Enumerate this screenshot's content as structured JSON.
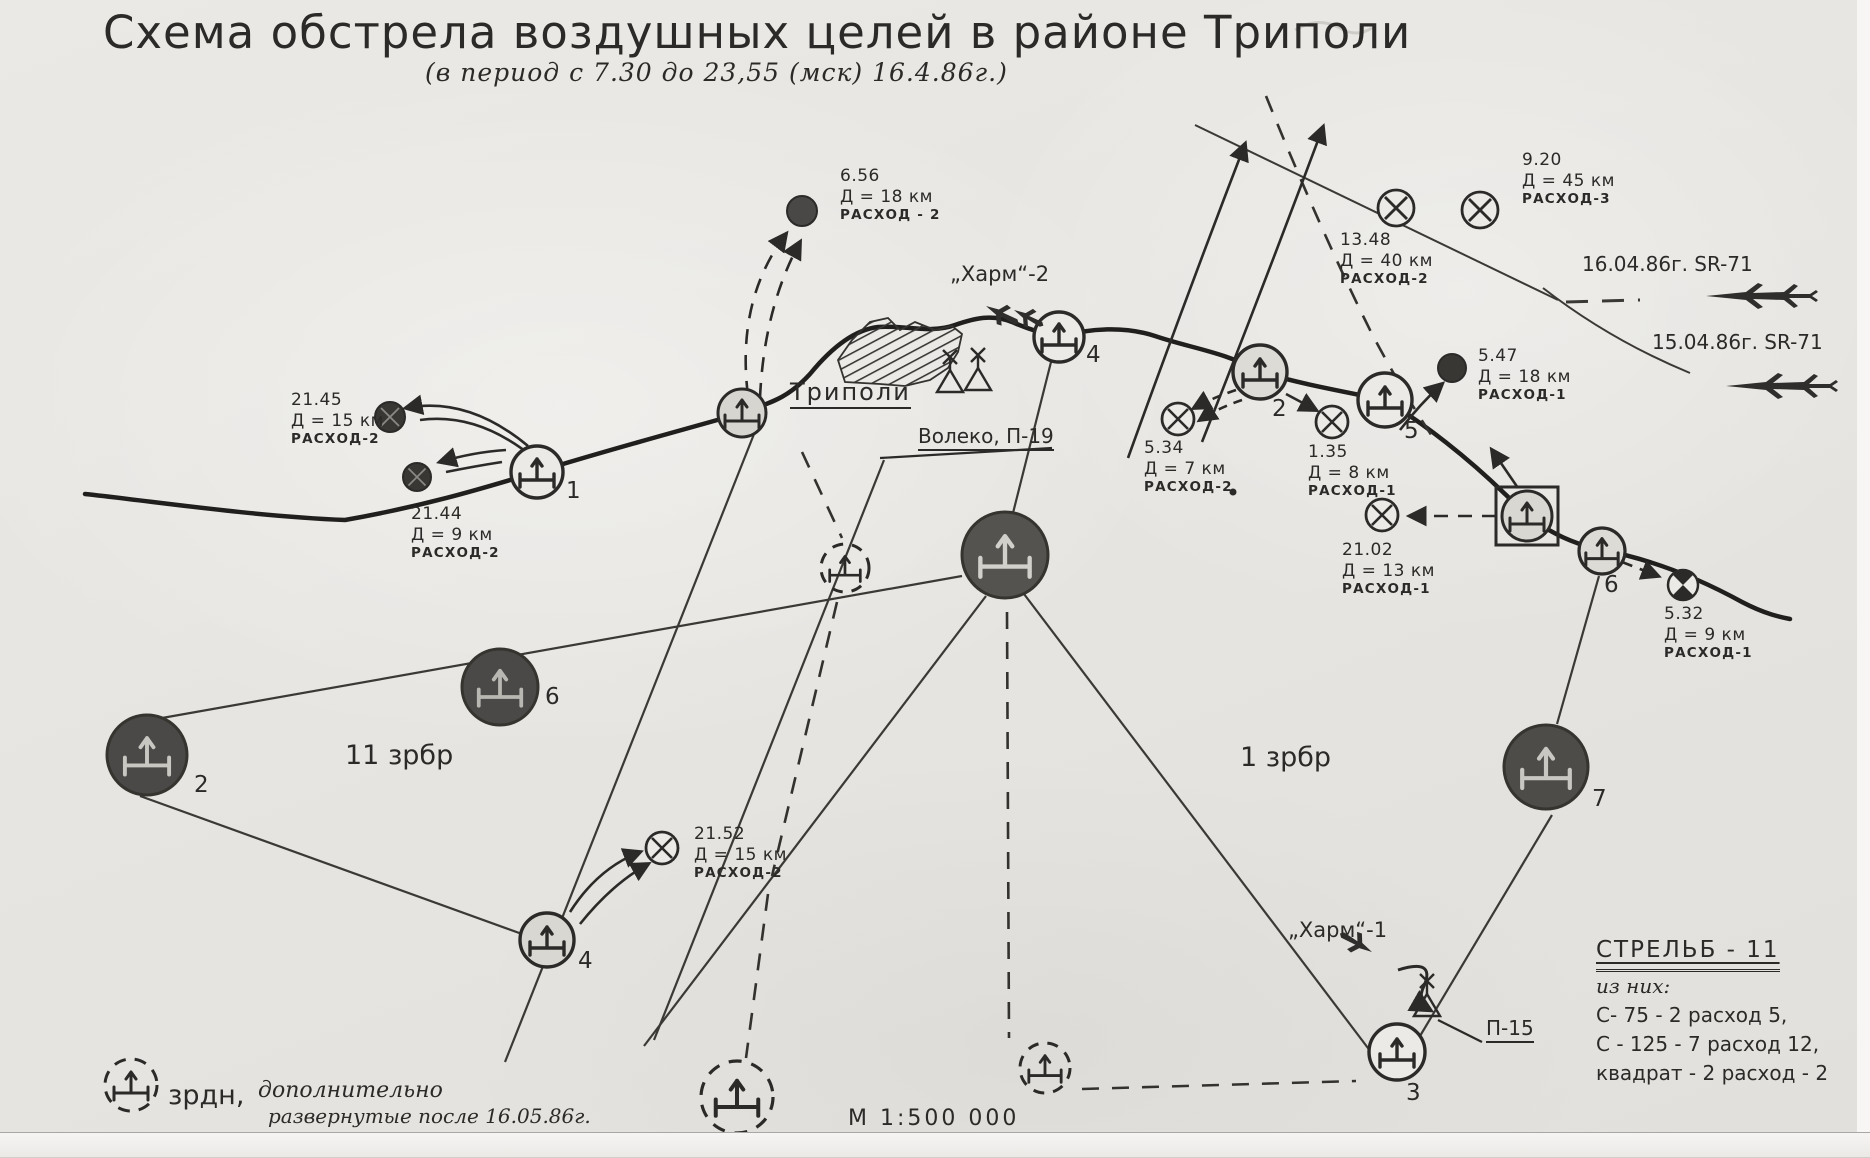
{
  "title": "Схема обстрела воздушных целей в районе Триполи",
  "subtitle": "(в период с 7.30 до 23,55 (мск) 16.4.86г.)",
  "labels": {
    "city": "Триполи",
    "radar_p19": "Волеко, П-19",
    "radar_p15": "П-15",
    "harm_2": "„Харм“-2",
    "harm_1": "„Харм“-1",
    "brigade_west": "11 зрбр",
    "brigade_east": "1 зрбр",
    "sr71_track_1604": "16.04.86г.  SR-71",
    "sr71_track_1504": "15.04.86г.  SR-71",
    "scale": "М  1:500 000"
  },
  "engagements": [
    {
      "time": "6.56",
      "range": "Д = 18 км",
      "expenditure": "расход - 2"
    },
    {
      "time": "9.20",
      "range": "Д = 45 км",
      "expenditure": "расход-3"
    },
    {
      "time": "13.48",
      "range": "Д = 40 км",
      "expenditure": "расход-2"
    },
    {
      "time": "21.45",
      "range": "Д = 15 км",
      "expenditure": "расход-2"
    },
    {
      "time": "21.44",
      "range": "Д = 9 км",
      "expenditure": "расход-2"
    },
    {
      "time": "5.47",
      "range": "Д = 18 км",
      "expenditure": "расход-1"
    },
    {
      "time": "5.34",
      "range": "Д = 7 км",
      "expenditure": "расход-2"
    },
    {
      "time": "1.35",
      "range": "Д = 8 км",
      "expenditure": "расход-1"
    },
    {
      "time": "21.02",
      "range": "Д = 13 км",
      "expenditure": "расход-1"
    },
    {
      "time": "5.32",
      "range": "Д = 9 км",
      "expenditure": "расход-1"
    },
    {
      "time": "21.52",
      "range": "Д = 15 км",
      "expenditure": "расход-2"
    }
  ],
  "sites": {
    "w1": "1",
    "w2": "2",
    "w4": "4",
    "w6": "6",
    "e2": "2",
    "e3": "3",
    "e4": "4",
    "e5": "5",
    "e6": "6",
    "e7": "7"
  },
  "legend": {
    "additional_term": "зрдн,",
    "additional_note_1": "дополнительно",
    "additional_note_2": "развернутые после 16.05.86г.",
    "firings_title": "стрельб - 11",
    "firings_subtitle": "из них:",
    "firings_lines": [
      "С- 75 - 2 расход 5,",
      "С - 125 - 7 расход 12,",
      "квадрат - 2 расход - 2"
    ]
  },
  "colors": {
    "ink": "#2b2a28",
    "dark_fill": "#4b4947",
    "paper": "#e8e6e2"
  }
}
